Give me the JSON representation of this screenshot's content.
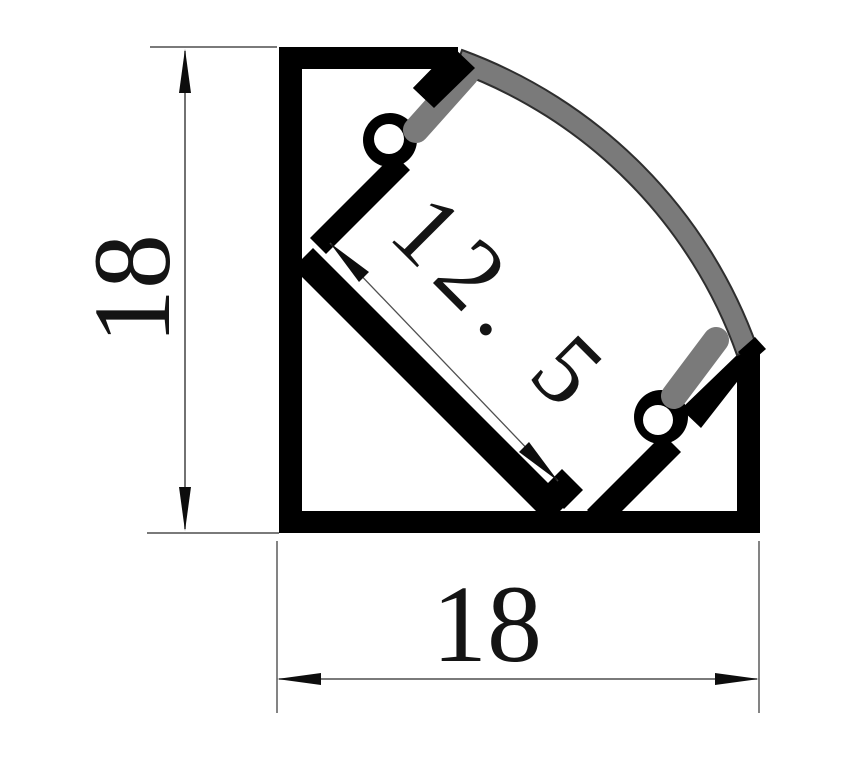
{
  "drawing": {
    "profile_height_label": "18",
    "profile_width_label": "18",
    "slot_width_label": "12. 5",
    "colors": {
      "body": "#000000",
      "diffuser": "#7a7a7a",
      "groove": "#ffffff",
      "dimension_line": "#4f4f4f",
      "arrow": "#0d0d0d",
      "label": "#141414",
      "background": "#ffffff"
    }
  }
}
